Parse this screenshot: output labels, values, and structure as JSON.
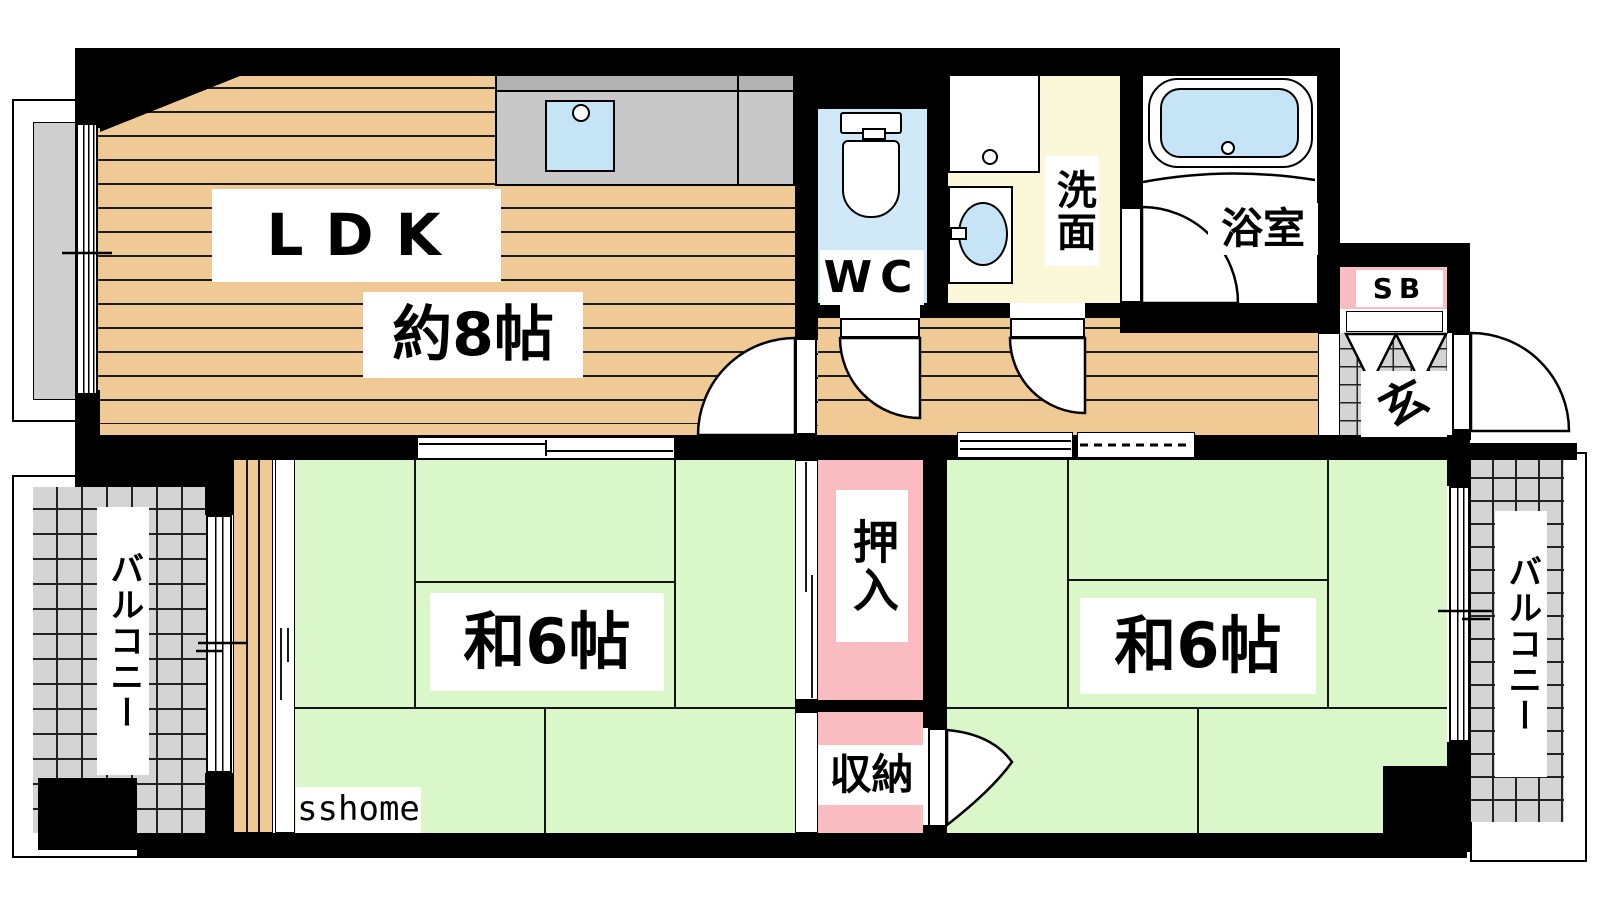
{
  "labels": {
    "ldk": "LDK",
    "ldk_size": "約8帖",
    "tatami_left": "和6帖",
    "tatami_right": "和6帖",
    "wc": "WC",
    "washroom": "洗面",
    "bath": "浴室",
    "shoe_box": "SB",
    "entrance": "玄",
    "closet": "押入",
    "storage": "収納",
    "balcony_left": "バルコニー",
    "balcony_right": "バルコニー",
    "watermark": "sshome"
  },
  "colors": {
    "wall": "#000000",
    "wood_floor": "#f0ca94",
    "tatami_green": "#d9f7c9",
    "closet_pink": "#f9bdc1",
    "wc_floor_blue": "#cfe9f9",
    "water_blue": "#c5e5f6",
    "washroom_yellow": "#fbf7d9",
    "tile_gray": "#d4d4d4",
    "counter_gray": "#c8c8c8"
  }
}
